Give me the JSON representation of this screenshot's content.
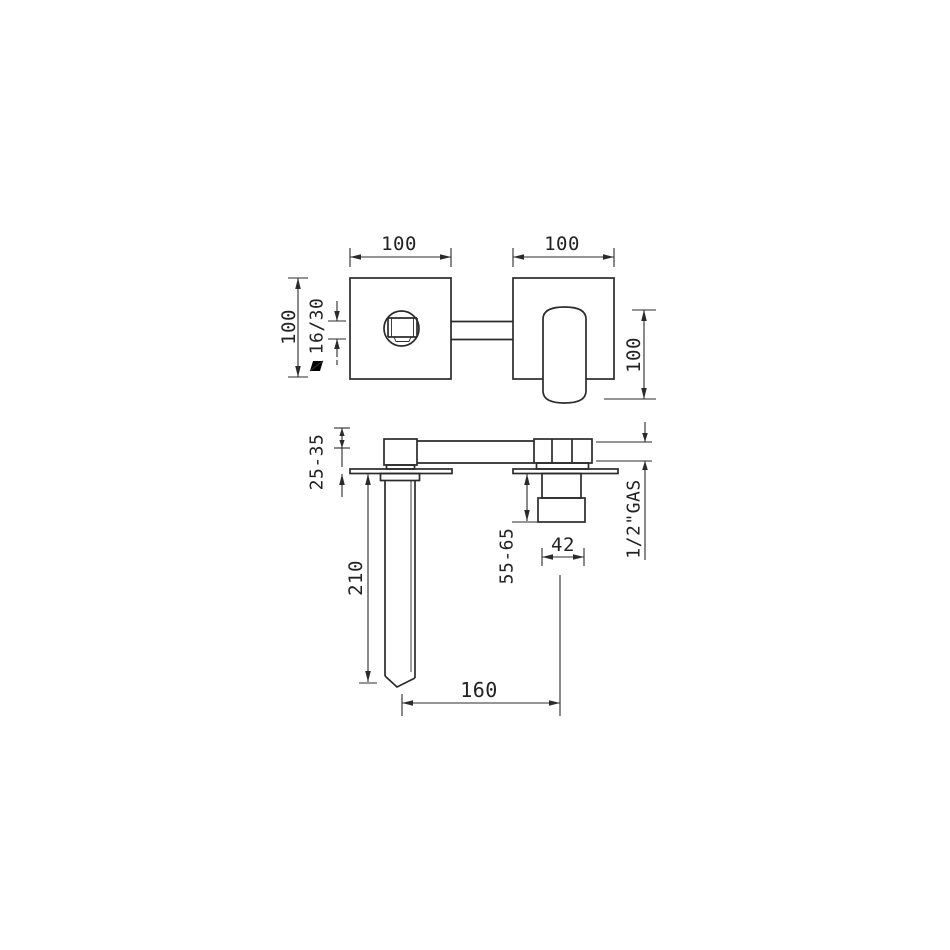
{
  "top_view": {
    "dim_width_left": "100",
    "dim_width_right": "100",
    "dim_height_left": "100",
    "dim_outlet_size": "16/30",
    "dim_handle_length": "100"
  },
  "front_view": {
    "dim_wall_adjust": "25-35",
    "dim_spout_drop": "210",
    "dim_valve_drop": "55-65",
    "dim_valve_width": "42",
    "dim_spout_reach": "160",
    "dim_inlet_thread": "1/2\"GAS"
  },
  "colors": {
    "line": "#2b2b2b",
    "background": "#ffffff"
  }
}
